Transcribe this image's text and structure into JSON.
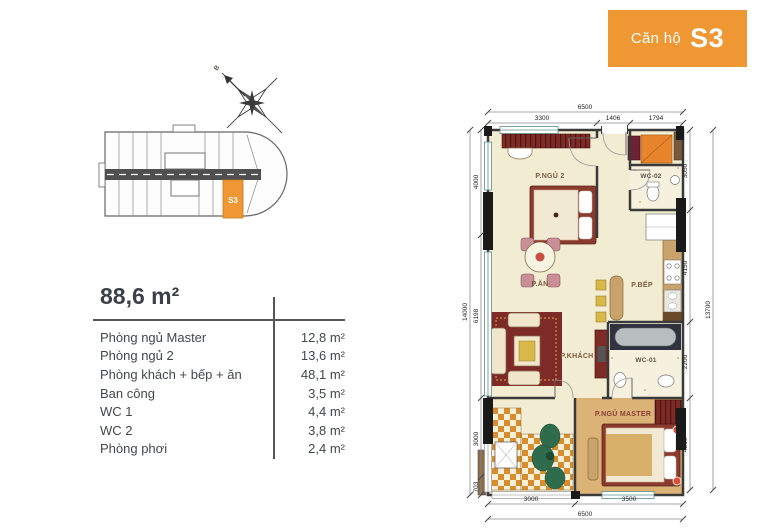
{
  "badge": {
    "prefix": "Căn hộ",
    "unit": "S3",
    "bg_color": "#EF9733"
  },
  "compass": {
    "north_label": "B"
  },
  "overview": {
    "unit_label": "S3",
    "highlight_color": "#EF9733"
  },
  "summary": {
    "total_area": "88,6 m²",
    "rows": [
      {
        "label": "Phòng ngủ Master",
        "area": "12,8 m²"
      },
      {
        "label": "Phòng ngủ 2",
        "area": "13,6 m²"
      },
      {
        "label": "Phòng khách + bếp + ăn",
        "area": "48,1 m²"
      },
      {
        "label": "Ban công",
        "area": "3,5 m²"
      },
      {
        "label": "WC 1",
        "area": "4,4 m²"
      },
      {
        "label": "WC 2",
        "area": "3,8 m²"
      },
      {
        "label": "Phòng phơi",
        "area": "2,4 m²"
      }
    ]
  },
  "plan": {
    "rooms": {
      "bedroom2": "P.NGỦ 2",
      "wc2": "WC-02",
      "dining": "P.ĂN",
      "kitchen": "P.BẾP",
      "living": "P.KHÁCH",
      "wc1": "WC-01",
      "master": "P.NGỦ MASTER"
    },
    "dims": {
      "top_total": "6500",
      "top_segments": [
        "3300",
        "1406",
        "1794"
      ],
      "left_total": "14000",
      "left_segments": [
        "4000",
        "6198",
        "3000",
        "703"
      ],
      "right_total": "13700",
      "right_segments": [
        "3050",
        "4150",
        "2200",
        "4300"
      ],
      "bottom_total": "6500",
      "bottom_segments": [
        "3000",
        "3500"
      ]
    }
  },
  "colors": {
    "accent_orange": "#EF9733",
    "floor_cream": "#F2EDD2",
    "master_tan": "#DCB377",
    "tile_orange": "#D98C2B",
    "wall_dark": "#3A3A3A",
    "dark_red": "#7E2A26"
  }
}
